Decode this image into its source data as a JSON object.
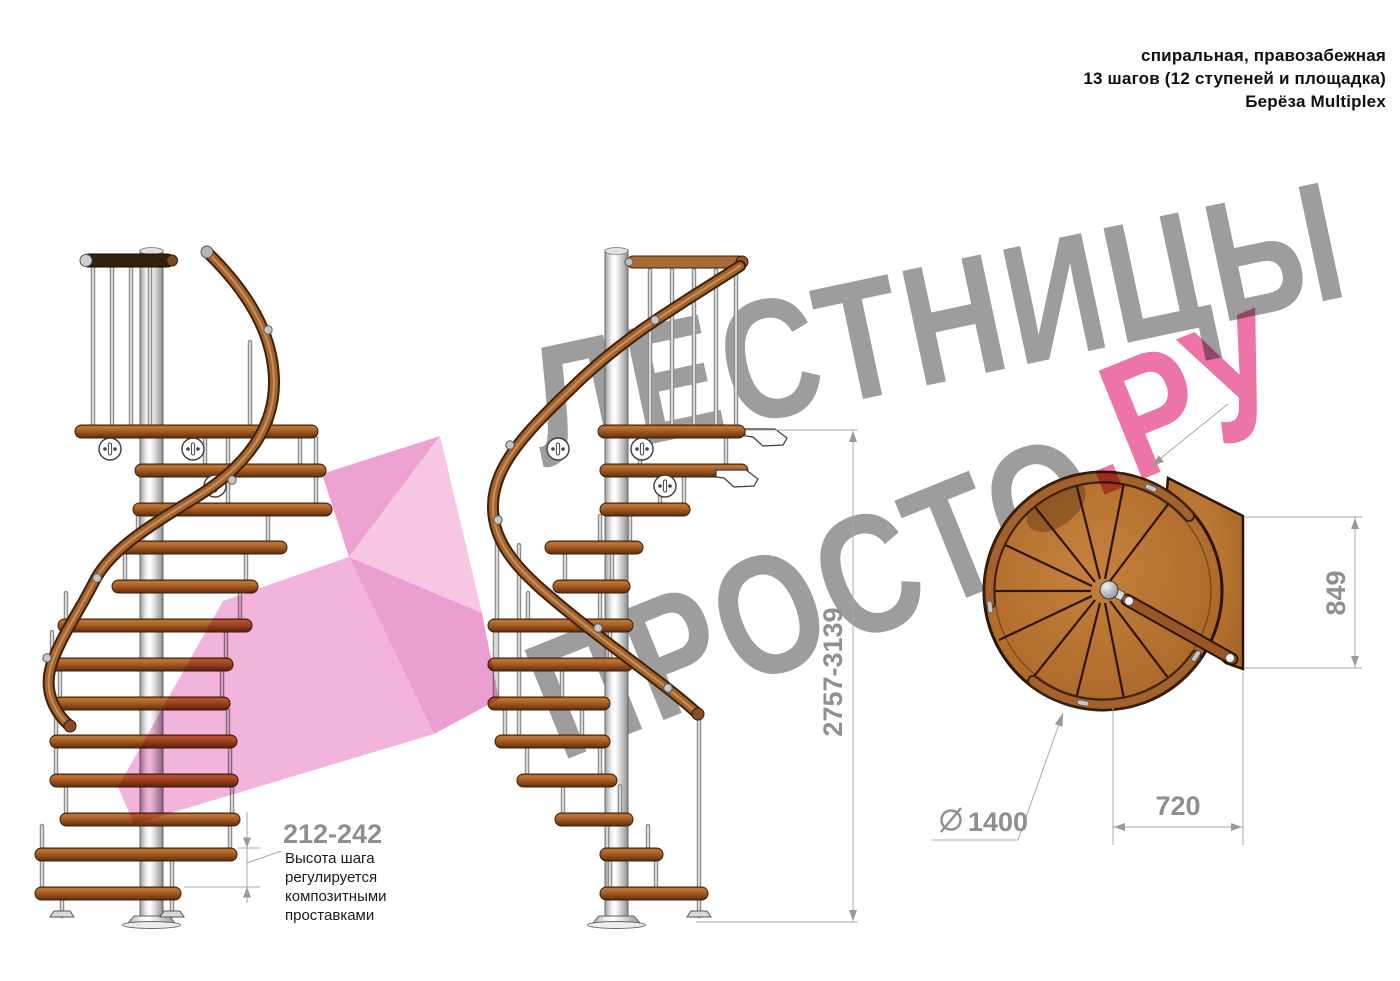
{
  "header": {
    "line1": "спиральная, правозабежная",
    "line2": "13 шагов (12 ступеней и площадка)",
    "line3": "Берёза Multiplex"
  },
  "watermark": {
    "word1": "ЛЕСТНИЦЫ",
    "word2": "ПРОСТО",
    "word3": ".РУ",
    "gray_color": "#9d9d9d",
    "pink_color": "#ec74a6",
    "arrow_pink": "#f2b4dc"
  },
  "dimensions": {
    "step_height": {
      "value": "212-242",
      "note_lines": [
        "Высота шага",
        "регулируется",
        "композитными",
        "проставками"
      ]
    },
    "total_height": {
      "value": "2757-3139"
    },
    "landing_height": {
      "value": "849"
    },
    "diameter": {
      "value": "1400",
      "symbol": "⌀"
    },
    "landing_width": {
      "value": "720"
    }
  },
  "colors": {
    "wood": "#b06c2e",
    "wood_dark": "#6b3411",
    "handrail": "#a2622e",
    "metal": "#c9c9c9",
    "dim_text": "#8f8f8f",
    "dim_line": "#a8a8a8",
    "note_text": "#1a1a1a"
  }
}
